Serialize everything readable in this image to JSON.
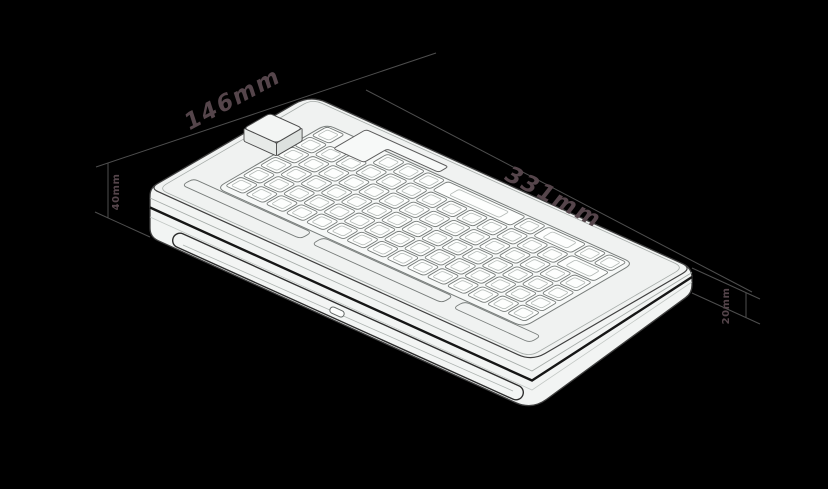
{
  "diagram": {
    "subject": "isometric-keyboard-case-dimension-drawing",
    "annotations": {
      "width": {
        "label": "331mm"
      },
      "depth": {
        "label": "146mm"
      },
      "height_back": {
        "label": "40mm"
      },
      "height_front": {
        "label": "20mm"
      }
    },
    "features": {
      "badge_block": "raised-block",
      "badge_notch": "l-shaped-cutout",
      "rear_bar": "rounded-accent-bar",
      "port": "small-port-cutout",
      "plate": "switch-cutout-grid"
    },
    "colors": {
      "background": "#000000",
      "dim_line": "#4e4e4e",
      "dim_text": "#55454b",
      "case_fill": "#f2f4f3",
      "face_fill": "#f0f2f1",
      "plate_fill": "#f6f8f7",
      "key_fill": "#fdfefd",
      "outline": "#3f3f3f",
      "detail": "#787d7b",
      "detail_light": "#a6aca9",
      "key_stroke": "#777c7a",
      "key_inner": "#b4bab7",
      "seam": "#161616",
      "bar_edge": "#2e2e2e",
      "bar_fill": "#f3f5f4",
      "block_side_a": "#e7eae8",
      "block_side_b": "#dde1df",
      "block_top": "#f3f5f4",
      "notch_fill": "#f7f9f8"
    }
  }
}
